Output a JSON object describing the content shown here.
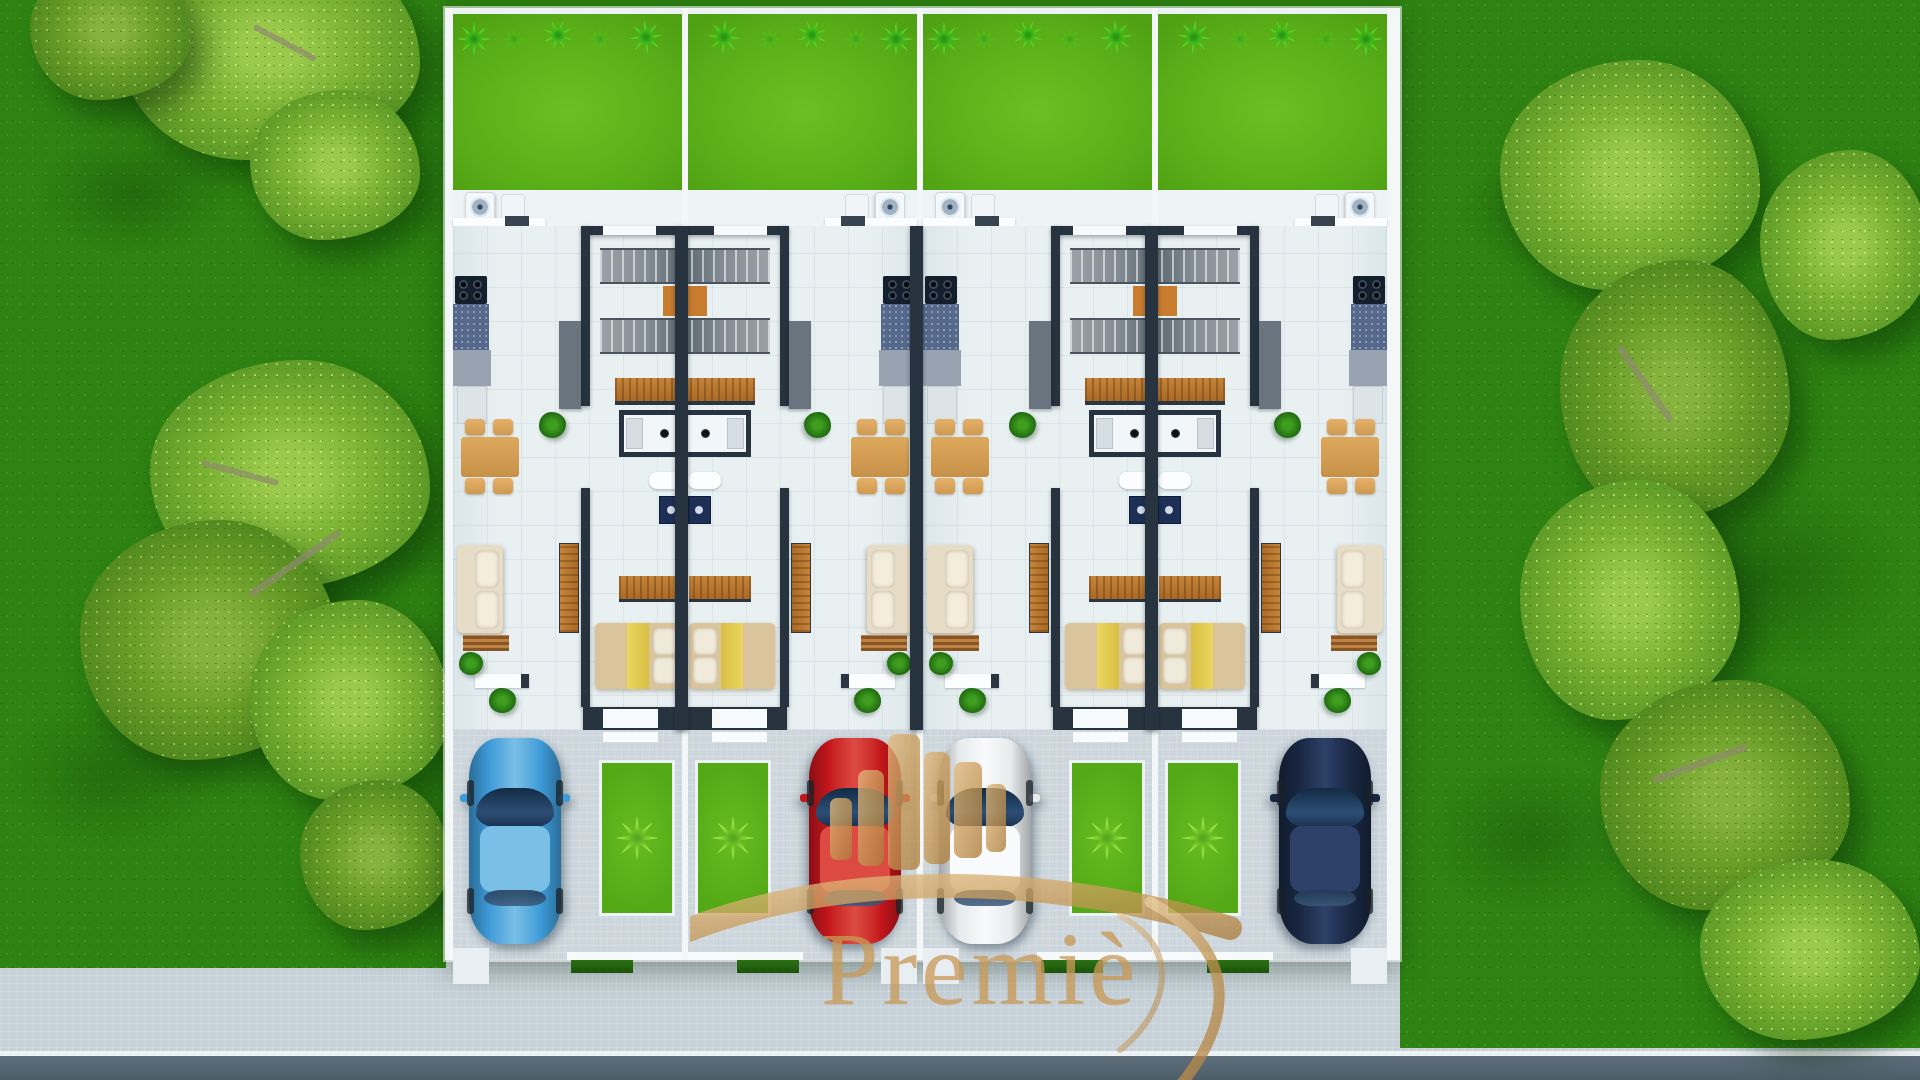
{
  "watermark": {
    "brand_text": "Premiè",
    "logo_label": "gold-skyline-emblem",
    "gold_color": "#c99a57"
  },
  "site": {
    "plot_label": "4-unit townhouse row, top view",
    "units": [
      {
        "name": "unit-1",
        "mirrored": false,
        "car": {
          "label": "blue car",
          "body_color": "#3d9bd8",
          "roof_color": "#79bfe6"
        }
      },
      {
        "name": "unit-2",
        "mirrored": true,
        "car": {
          "label": "red car",
          "body_color": "#c4161c",
          "roof_color": "#dd4a42"
        }
      },
      {
        "name": "unit-3",
        "mirrored": false,
        "car": {
          "label": "white car",
          "body_color": "#e8ebed",
          "roof_color": "#f8fafb"
        }
      },
      {
        "name": "unit-4",
        "mirrored": true,
        "car": {
          "label": "navy car",
          "body_color": "#182741",
          "roof_color": "#2d4168"
        }
      }
    ],
    "palette": {
      "backyard_green": "#58ad18",
      "field_green": "#2e8312",
      "tree_green": "#7ab233",
      "wall_dark": "#27333f",
      "floor_light": "#e9f0f2",
      "paver_gray": "#ccd6dc",
      "road_gray": "#56687a",
      "wood_orange": "#c5843a",
      "stair_landing_orange": "#c87c2e",
      "bed_yellow": "#ecd65e"
    }
  }
}
